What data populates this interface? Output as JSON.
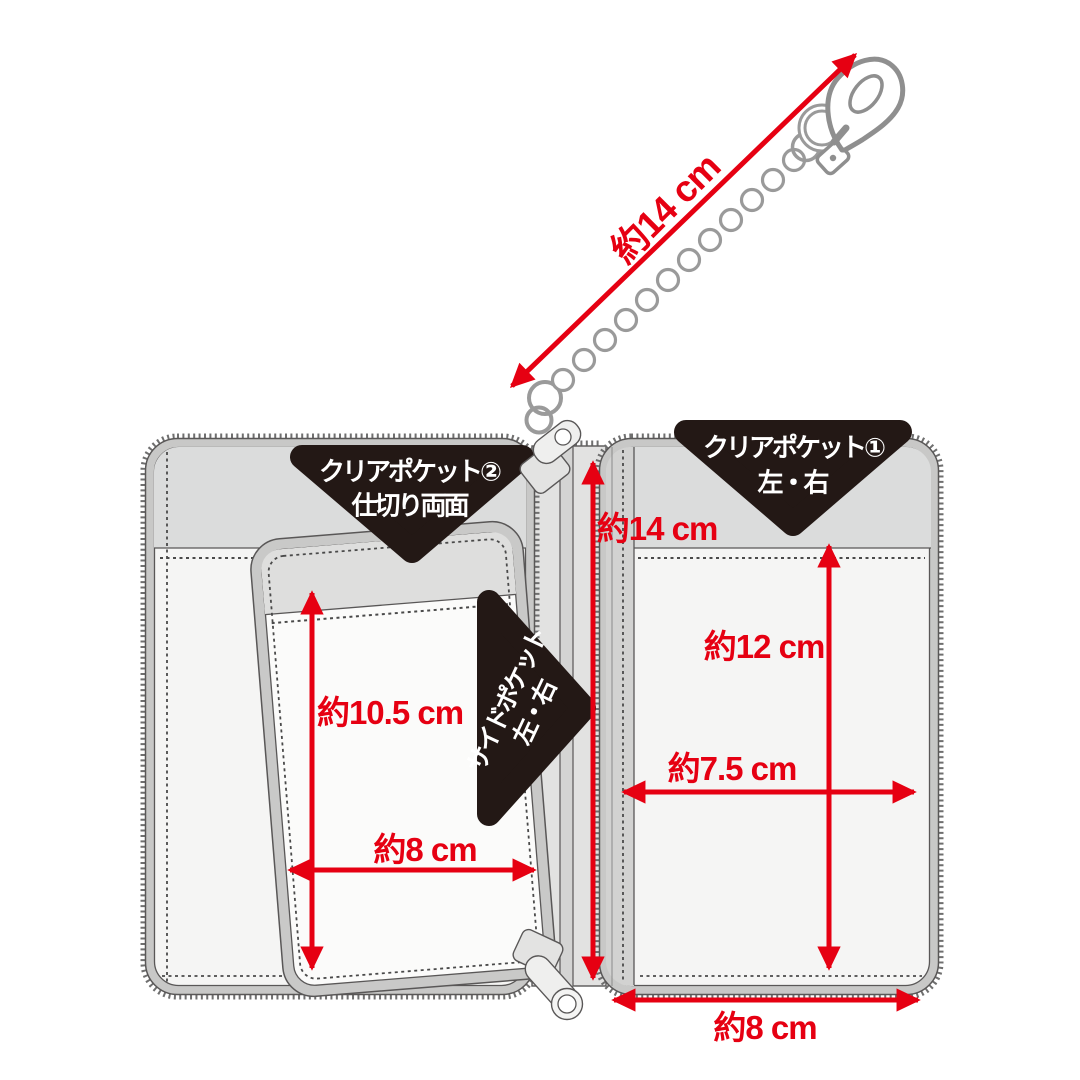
{
  "title": "pouch-dimension-diagram",
  "colors": {
    "dimension_red": "#e60012",
    "badge_black": "#231815",
    "trim_gray": "#c8c8c7",
    "band_gray": "#dbdcdc",
    "outline_gray": "#595757",
    "metal_gray": "#8f8f8f"
  },
  "labels": {
    "chain_length": "約14 cm",
    "body_height": "約14 cm",
    "pocket1_height": "約12 cm",
    "pocket1_width": "約7.5 cm",
    "pocket2_height": "約10.5 cm",
    "pocket2_width": "約8 cm",
    "body_width": "約8 cm"
  },
  "badges": {
    "clear_pocket2": {
      "line1": "クリアポケット②",
      "line2": "仕切り両面"
    },
    "clear_pocket1": {
      "line1": "クリアポケット①",
      "line2": "左・右"
    },
    "side_pocket": {
      "line1": "サイドポケット",
      "line2": "左・右"
    }
  }
}
